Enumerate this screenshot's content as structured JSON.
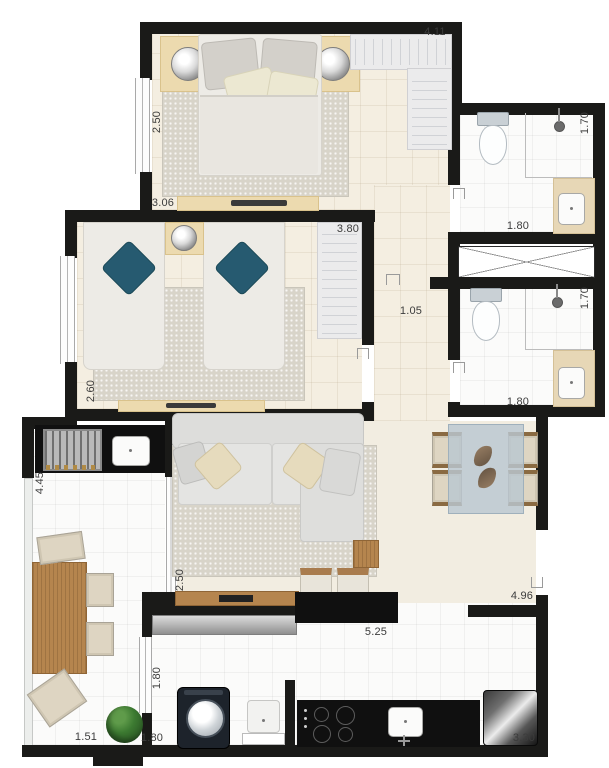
{
  "dimensions": {
    "bedroom1_width_top": "4.11",
    "bedroom1_depth_left": "2.50",
    "bedroom1_width_bottom": "3.06",
    "bedroom2_width_top": "3.80",
    "bedroom2_depth_left": "2.60",
    "hallway_width": "1.05",
    "bathroom1_depth_right": "1.70",
    "bathroom1_width_bottom": "1.80",
    "bathroom2_depth_right": "1.70",
    "bathroom2_width_bottom": "1.80",
    "living_depth_left": "2.50",
    "balcony_depth_left": "4.45",
    "balcony_width_bottom": "1.51",
    "laundry_depth_left": "1.80",
    "laundry_width_bottom": "1.80",
    "kitchen_width": "5.25",
    "kitchen_depth_right": "4.96",
    "kitchen_width_bottom": "3.30"
  },
  "colors": {
    "wall": "#1a1a18",
    "floor_beige": "#f4eee1",
    "floor_white": "#fbfbfa",
    "rug": "#d8d4c9",
    "wood": "#b5854e",
    "furniture_beige": "#ecdaaf",
    "pillow_teal": "#265a70",
    "counter_black": "#101010",
    "closet_gray": "#ebebec",
    "glass_table": "#b9c7d1",
    "plant_green": "#3c7a31",
    "label_text": "#3c3c3c"
  }
}
